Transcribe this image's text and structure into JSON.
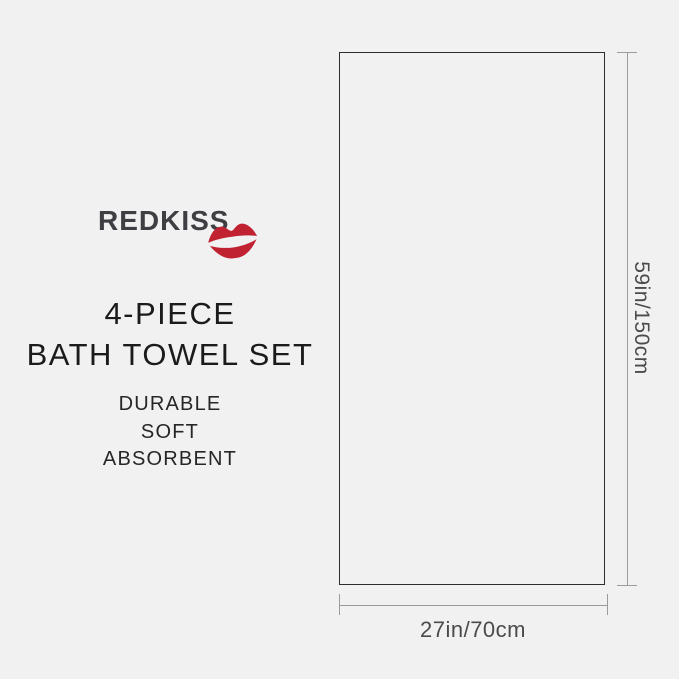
{
  "canvas": {
    "background_color": "#f1f1f2"
  },
  "brand": {
    "name": "REDKISS",
    "text_color": "#3e3e43",
    "kiss_icon_color": "#c12231"
  },
  "title": {
    "line1": "4-PIECE",
    "line2": "BATH TOWEL SET",
    "color": "#1b1b1b"
  },
  "features": {
    "items": [
      "DURABLE",
      "SOFT",
      "ABSORBENT"
    ],
    "color": "#262626"
  },
  "diagram": {
    "height_label": "59in/150cm",
    "width_label": "27in/70cm",
    "towel_outline_color": "#2d2d2d",
    "dimension_line_color": "#9b9b9b",
    "label_color": "#4b4b4b"
  }
}
